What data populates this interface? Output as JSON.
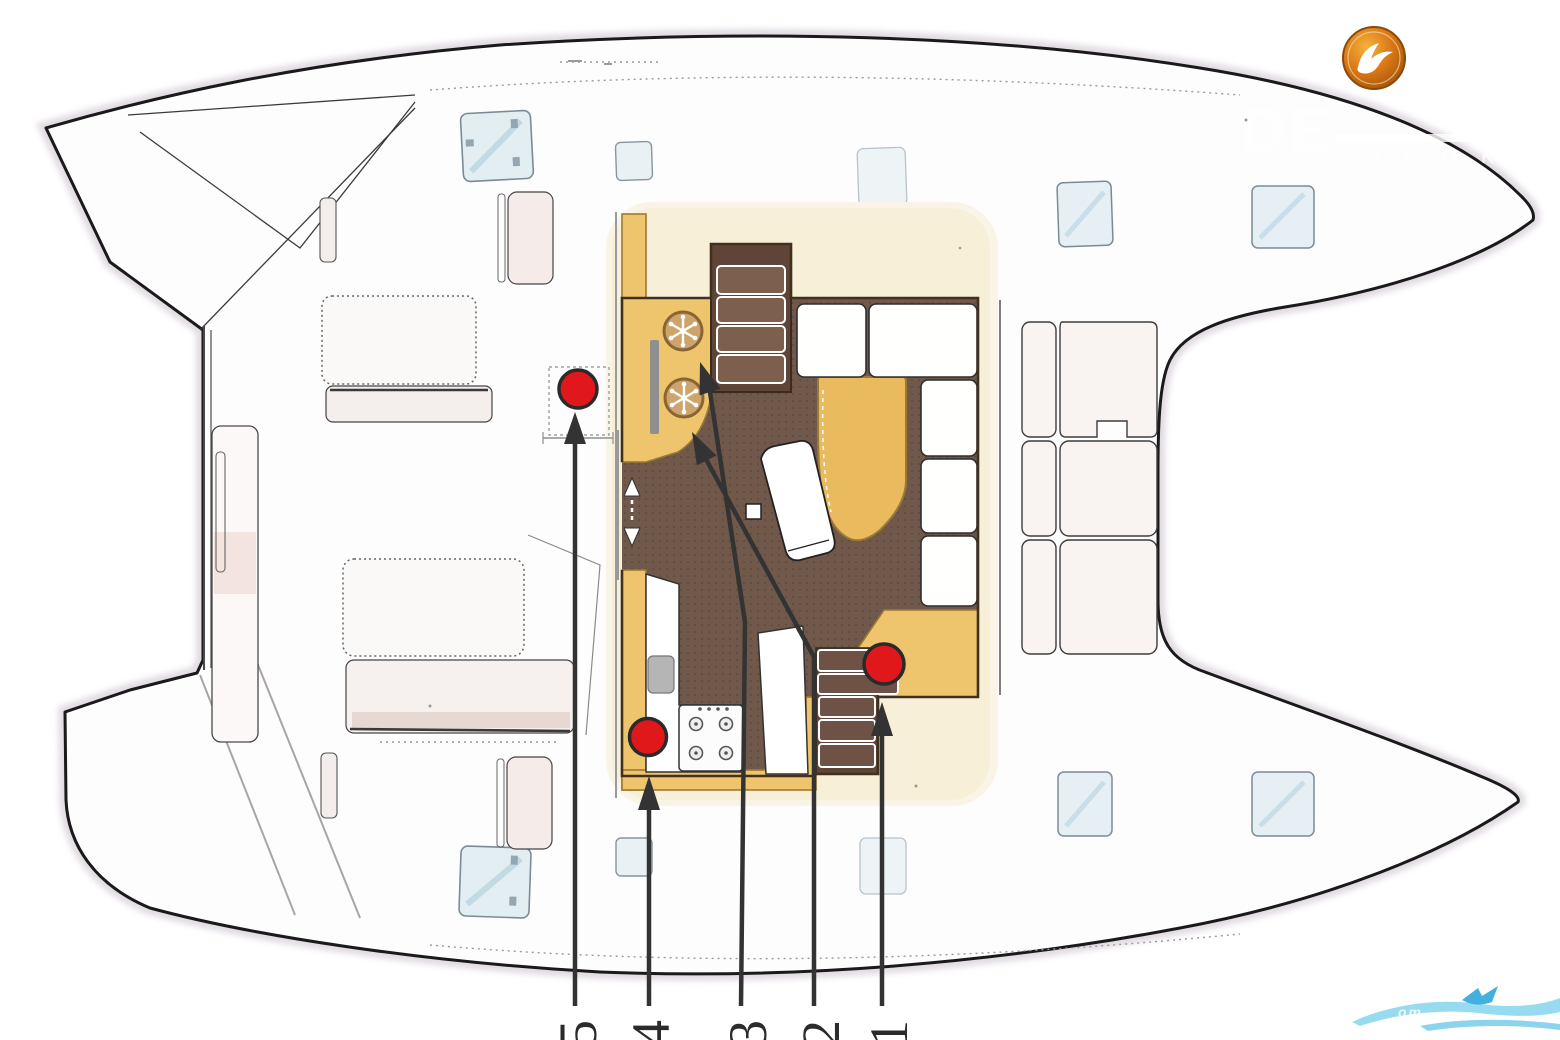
{
  "plan": {
    "title_hint": "catamaran deck and saloon layout plan (scanned safety/equipment sheet)",
    "callout_numbers": [
      "5",
      "4",
      "3",
      "2",
      "1"
    ]
  },
  "watermark": {
    "initials": "DE",
    "subtext": "BROKER",
    "bottom_text": "om"
  },
  "colors": {
    "marker_red": "#e0181c",
    "floor_brown": "#70584a",
    "furniture_yellow": "#eec46d",
    "salon_cream": "#f7efd8",
    "logo_orange": "#d97715",
    "swoosh_blue": "#6fcdec",
    "hull_outline": "#1a1a1a",
    "scan_halo": "#d5cdd6"
  }
}
